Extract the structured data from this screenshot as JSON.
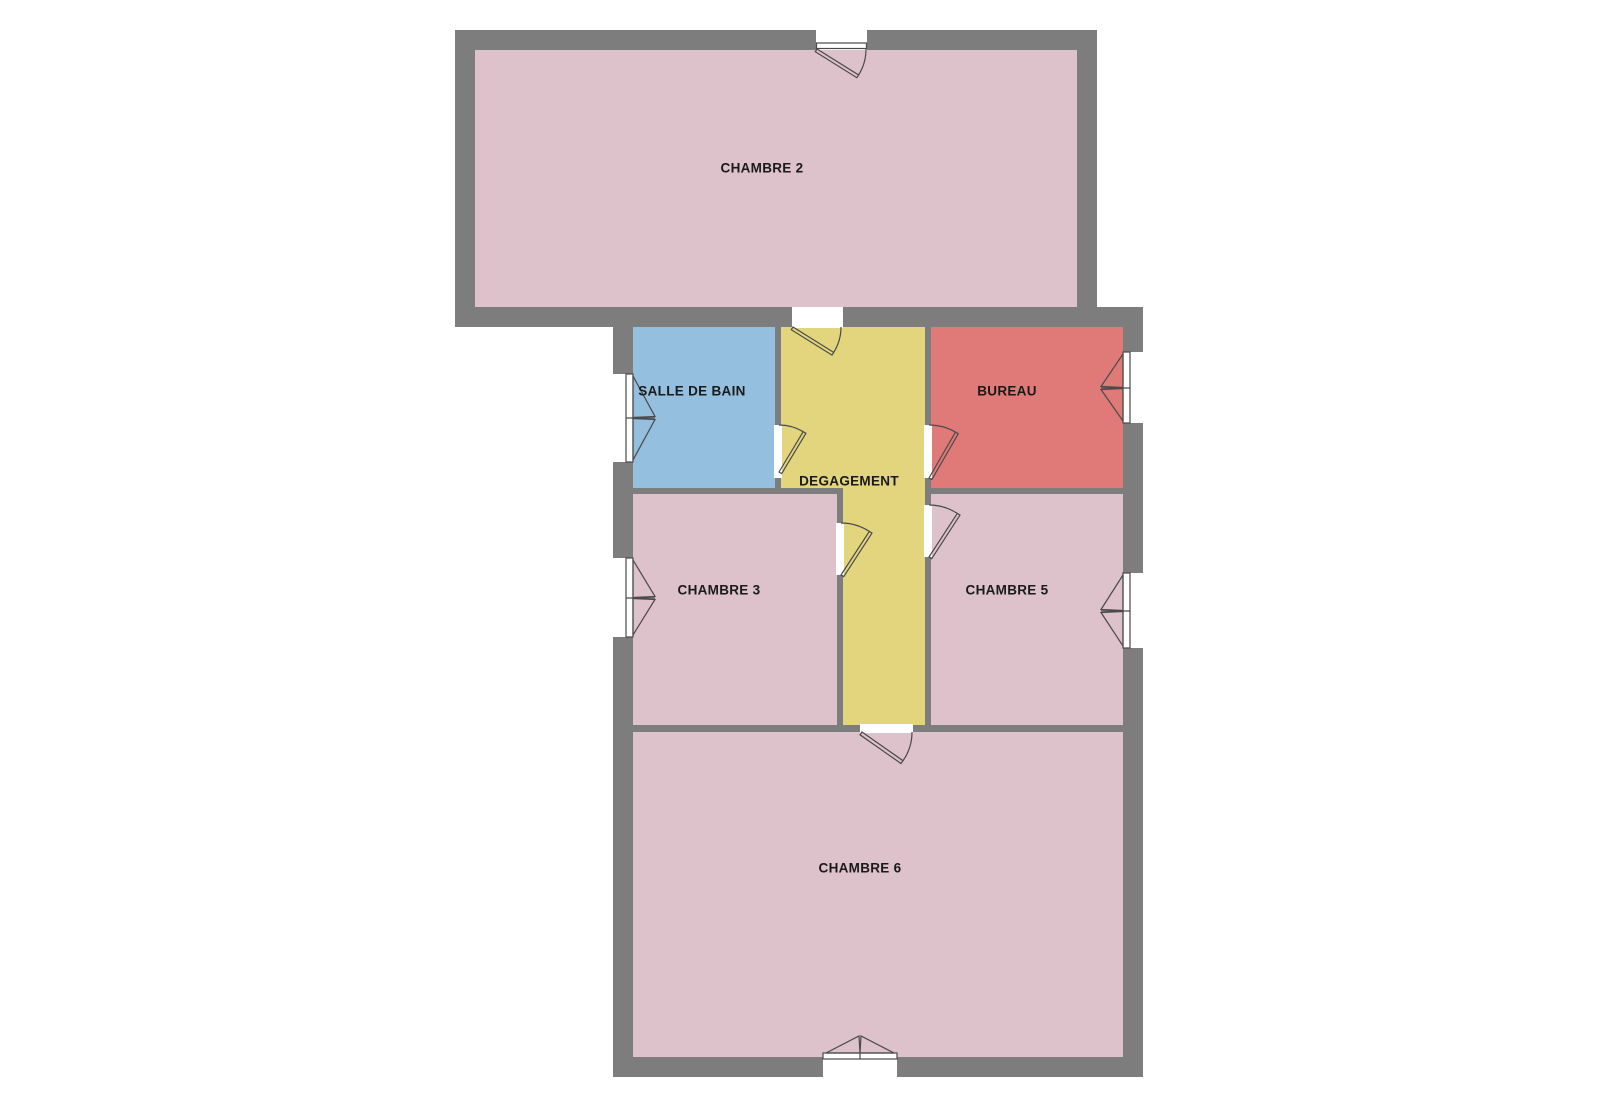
{
  "floorplan": {
    "rooms": [
      {
        "name": "chambre-2",
        "label": "CHAMBRE 2",
        "color": "#ddc1cb"
      },
      {
        "name": "salle-de-bain",
        "label": "SALLE DE BAIN",
        "color": "#94bfdf"
      },
      {
        "name": "degagement",
        "label": "DEGAGEMENT",
        "color": "#e2d57d"
      },
      {
        "name": "bureau",
        "label": "BUREAU",
        "color": "#e07a78"
      },
      {
        "name": "chambre-3",
        "label": "CHAMBRE 3",
        "color": "#ddc1cb"
      },
      {
        "name": "chambre-5",
        "label": "CHAMBRE 5",
        "color": "#ddc1cb"
      },
      {
        "name": "chambre-6",
        "label": "CHAMBRE 6",
        "color": "#ddc1cb"
      }
    ],
    "colors": {
      "wall": "#7d7d7d",
      "background": "#ffffff",
      "glyph_stroke": "#4a4a4a",
      "label_text": "#1a1a1a"
    }
  }
}
